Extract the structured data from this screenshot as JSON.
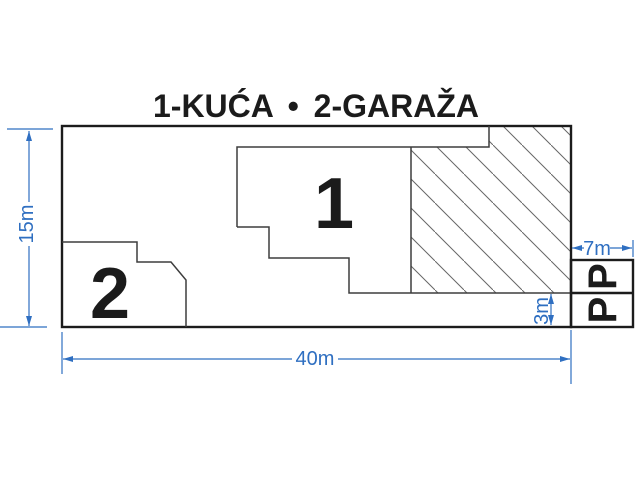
{
  "title": "1-KUĆA • 2-GARAŽA",
  "plan": {
    "house_label": "1",
    "garage_label": "2",
    "parking_label": "P"
  },
  "dimensions": {
    "plot_width": "40m",
    "plot_height": "15m",
    "parking_width": "7m",
    "setback_height": "3m"
  },
  "colors": {
    "dimension_blue": "#2f6fc1",
    "outline_dark": "#1c1c1c",
    "line_medium": "#3d3d3d",
    "hatch_gray": "#666666",
    "text_black": "#1b1b1b",
    "background": "#ffffff"
  }
}
